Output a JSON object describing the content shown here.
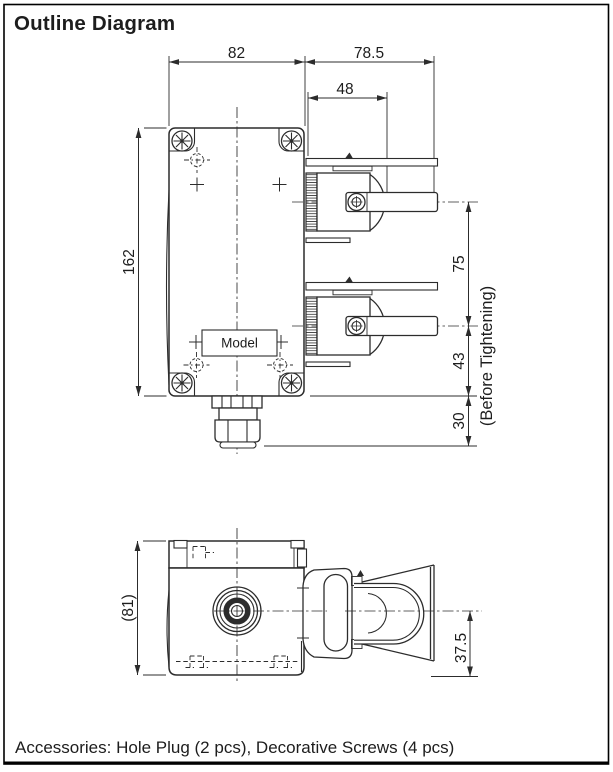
{
  "page": {
    "title": "Outline Diagram",
    "accessories_note": "Accessories: Hole Plug (2 pcs), Decorative Screws (4 pcs)"
  },
  "front_view": {
    "model_label": "Model",
    "dim_width": "82",
    "dim_side_width": "78.5",
    "dim_lever_center": "48",
    "dim_height": "162",
    "dim_lever_pitch": "75",
    "dim_lower": "43",
    "dim_gland": "30",
    "note_before_tightening": "(Before Tightening)"
  },
  "top_view": {
    "dim_depth": "(81)",
    "dim_lever_height": "37.5"
  },
  "colors": {
    "line": "#2c2c2c",
    "background": "#ffffff",
    "border": "#000000"
  }
}
